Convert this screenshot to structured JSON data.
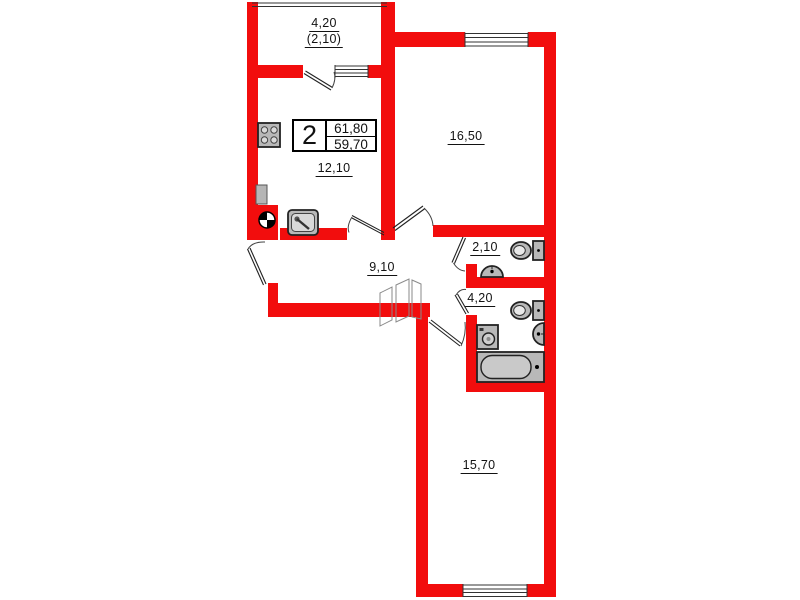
{
  "plan": {
    "title": "2-room apartment floor plan",
    "stats": {
      "rooms": "2",
      "total_area": "61,80",
      "living_area": "59,70"
    },
    "rooms": {
      "balcony": {
        "area": "4,20",
        "area_reduced": "(2,10)"
      },
      "kitchen": {
        "area": "12,10"
      },
      "living_room": {
        "area": "16,50"
      },
      "wc": {
        "area": "2,10"
      },
      "bathroom": {
        "area": "4,20"
      },
      "hallway": {
        "area": "9,10"
      },
      "bedroom": {
        "area": "15,70"
      }
    }
  },
  "colors": {
    "wall": "#f20d0d",
    "fixture-fill": "#b8b8b8",
    "fixture-stroke": "#222222",
    "thin-line": "#333333",
    "text": "#121212"
  }
}
